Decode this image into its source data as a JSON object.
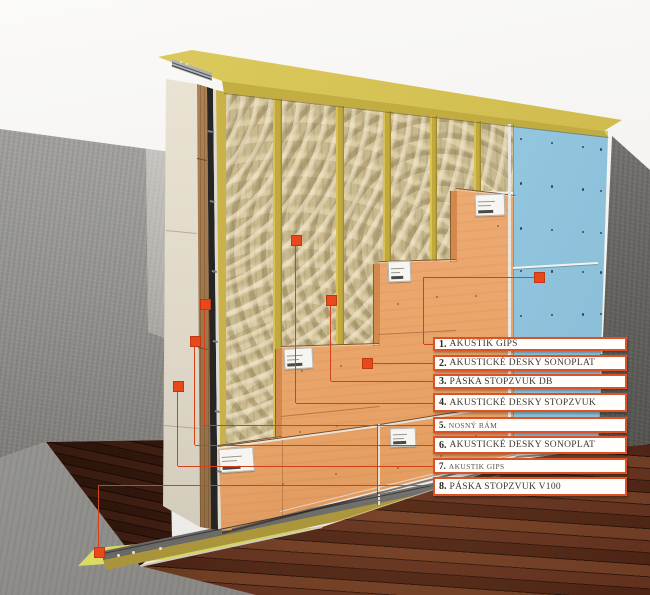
{
  "diagram": {
    "type": "acoustic-partition-wall-cutaway",
    "legend_items": [
      {
        "num": "1.",
        "label": "AKUSTIK GIPS",
        "compact": false
      },
      {
        "num": "2.",
        "label": "AKUSTICKÉ DESKY SONOPLAT",
        "compact": false
      },
      {
        "num": "3.",
        "label": "PÁSKA STOPZVUK DB",
        "compact": false
      },
      {
        "num": "4.",
        "label": "AKUSTICKÉ DESKY STOPZVUK",
        "compact": false
      },
      {
        "num": "5.",
        "label": "NOSNÝ RÁM",
        "compact": true
      },
      {
        "num": "6.",
        "label": "AKUSTICKÉ DESKY SONOPLAT",
        "compact": false
      },
      {
        "num": "7.",
        "label": "AKUSTIK GIPS",
        "compact": true
      },
      {
        "num": "8.",
        "label": "PÁSKA STOPZVUK V100",
        "compact": false
      }
    ],
    "colors": {
      "legend_border": "#dd5126",
      "marker": "#e8491c",
      "leader_line": "#d1431a",
      "gips_blue": "#97c9e2",
      "sonoplat_orange": "#ecaa72",
      "insulation_tan": "#c9b98f",
      "frame_yellow": "#c2a93e",
      "tape_yellow_green": "#d9d965",
      "concrete_gray": "#8a8986",
      "wood_floor_brown": "#552a18"
    }
  }
}
